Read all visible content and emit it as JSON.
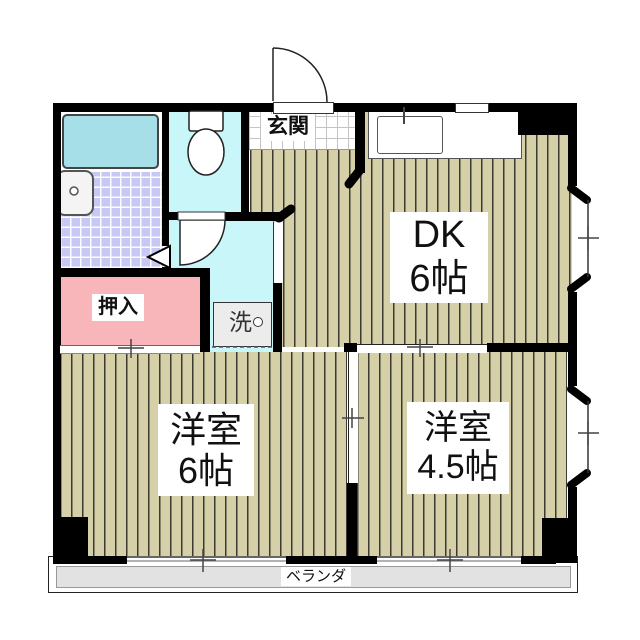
{
  "plan": {
    "type": "apartment-floor-plan",
    "labels": {
      "genkan": "玄関",
      "dk_line1": "DK",
      "dk_line2": "6帖",
      "room6_line1": "洋室",
      "room6_line2": "6帖",
      "room45_line1": "洋室",
      "room45_line2": "4.5帖",
      "oshiire": "押入",
      "laundry": "洗",
      "veranda": "ベランダ"
    },
    "rooms": [
      {
        "label": "DK 6帖"
      },
      {
        "label": "洋室 6帖"
      },
      {
        "label": "洋室 4.5帖"
      },
      {
        "label": "玄関"
      },
      {
        "label": "押入"
      },
      {
        "label": "ベランダ"
      }
    ],
    "fixtures": [
      "bathtub",
      "washbasin",
      "toilet",
      "kitchen-sink",
      "washing-machine-pan"
    ],
    "openings": {
      "entry_door": "hinged-outswing",
      "toilet_door": "hinged",
      "bathroom_door": "folding-triangle",
      "sliding_partitions": 3,
      "windows": 5
    },
    "colors": {
      "wall": "#000000",
      "floor_wood": "#d6d0a8",
      "floor_stripe": "#3a3a32",
      "tile_bathroom": "#c7c9f4",
      "room_wet": "#c9f6f8",
      "bathtub": "#a6dfe8",
      "closet_pink": "#f9b6ba",
      "balcony": "#e2e2e2",
      "genkan_tile": "#ffffff",
      "laundry_pan": "#ececec"
    }
  }
}
